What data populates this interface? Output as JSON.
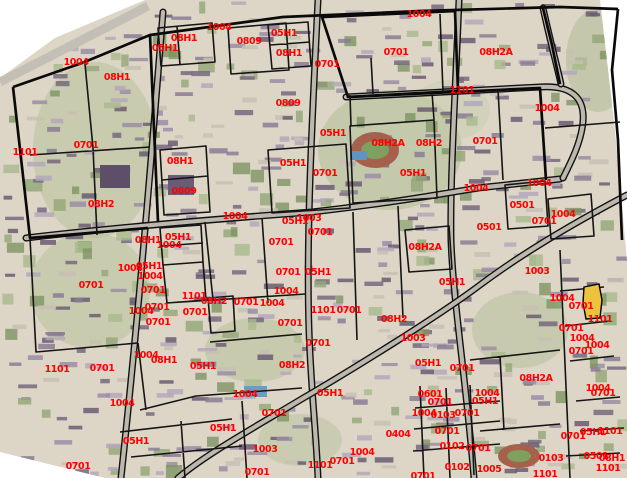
{
  "map": {
    "width": 627,
    "height": 478,
    "colors": {
      "label": "#ff0000",
      "boundary": "#000000",
      "road": "#bdb8ae",
      "ground": "#ddd5c6",
      "highlight": "#edc23f"
    },
    "highlight_parcel": {
      "label": "0701",
      "x": 591,
      "y": 302
    },
    "labels": [
      {
        "t": "1004",
        "x": 76,
        "y": 62
      },
      {
        "t": "08H1",
        "x": 117,
        "y": 77
      },
      {
        "t": "1101",
        "x": 25,
        "y": 152
      },
      {
        "t": "0701",
        "x": 86,
        "y": 145
      },
      {
        "t": "08H2",
        "x": 101,
        "y": 204
      },
      {
        "t": "05H1",
        "x": 165,
        "y": 48
      },
      {
        "t": "08H1",
        "x": 184,
        "y": 38
      },
      {
        "t": "1004",
        "x": 219,
        "y": 27
      },
      {
        "t": "0809",
        "x": 249,
        "y": 41
      },
      {
        "t": "05H1",
        "x": 284,
        "y": 33
      },
      {
        "t": "08H1",
        "x": 289,
        "y": 53
      },
      {
        "t": "0701",
        "x": 327,
        "y": 64
      },
      {
        "t": "1004",
        "x": 419,
        "y": 14
      },
      {
        "t": "0701",
        "x": 396,
        "y": 52
      },
      {
        "t": "08H2A",
        "x": 496,
        "y": 52
      },
      {
        "t": "1101",
        "x": 462,
        "y": 90
      },
      {
        "t": "1004",
        "x": 547,
        "y": 108
      },
      {
        "t": "0809",
        "x": 288,
        "y": 103
      },
      {
        "t": "08H1",
        "x": 180,
        "y": 161
      },
      {
        "t": "05H1",
        "x": 293,
        "y": 163
      },
      {
        "t": "0701",
        "x": 325,
        "y": 173
      },
      {
        "t": "0809",
        "x": 184,
        "y": 191
      },
      {
        "t": "05H1",
        "x": 333,
        "y": 133
      },
      {
        "t": "08H2A",
        "x": 388,
        "y": 143
      },
      {
        "t": "08H2",
        "x": 429,
        "y": 143
      },
      {
        "t": "0701",
        "x": 485,
        "y": 141
      },
      {
        "t": "05H1",
        "x": 413,
        "y": 173
      },
      {
        "t": "1004",
        "x": 235,
        "y": 216
      },
      {
        "t": "1004",
        "x": 476,
        "y": 188
      },
      {
        "t": "1004",
        "x": 539,
        "y": 183
      },
      {
        "t": "0501",
        "x": 522,
        "y": 205
      },
      {
        "t": "1004",
        "x": 563,
        "y": 214
      },
      {
        "t": "0701",
        "x": 544,
        "y": 221
      },
      {
        "t": "0501",
        "x": 489,
        "y": 227
      },
      {
        "t": "05H1",
        "x": 295,
        "y": 221
      },
      {
        "t": "1003",
        "x": 309,
        "y": 218
      },
      {
        "t": "0701",
        "x": 320,
        "y": 232
      },
      {
        "t": "08H1",
        "x": 148,
        "y": 240
      },
      {
        "t": "05H1",
        "x": 178,
        "y": 237
      },
      {
        "t": "1004",
        "x": 169,
        "y": 245
      },
      {
        "t": "0701",
        "x": 281,
        "y": 242
      },
      {
        "t": "08H2A",
        "x": 425,
        "y": 247
      },
      {
        "t": "1003",
        "x": 537,
        "y": 271
      },
      {
        "t": "05H1",
        "x": 452,
        "y": 282
      },
      {
        "t": "1004",
        "x": 130,
        "y": 268
      },
      {
        "t": "05H1",
        "x": 149,
        "y": 266
      },
      {
        "t": "1004",
        "x": 150,
        "y": 276
      },
      {
        "t": "0701",
        "x": 91,
        "y": 285
      },
      {
        "t": "0701",
        "x": 153,
        "y": 290
      },
      {
        "t": "1101",
        "x": 194,
        "y": 296
      },
      {
        "t": "0701",
        "x": 288,
        "y": 272
      },
      {
        "t": "05H1",
        "x": 318,
        "y": 272
      },
      {
        "t": "1004",
        "x": 286,
        "y": 291
      },
      {
        "t": "1004",
        "x": 141,
        "y": 311
      },
      {
        "t": "0701",
        "x": 157,
        "y": 307
      },
      {
        "t": "0701",
        "x": 158,
        "y": 322
      },
      {
        "t": "0701",
        "x": 195,
        "y": 312
      },
      {
        "t": "08H2",
        "x": 214,
        "y": 301
      },
      {
        "t": "0701",
        "x": 246,
        "y": 302
      },
      {
        "t": "1004",
        "x": 272,
        "y": 303
      },
      {
        "t": "1101",
        "x": 323,
        "y": 310
      },
      {
        "t": "0701",
        "x": 349,
        "y": 310
      },
      {
        "t": "08H2",
        "x": 394,
        "y": 319
      },
      {
        "t": "0701",
        "x": 290,
        "y": 323
      },
      {
        "t": "0701",
        "x": 318,
        "y": 343
      },
      {
        "t": "1004",
        "x": 146,
        "y": 355
      },
      {
        "t": "08H1",
        "x": 164,
        "y": 360
      },
      {
        "t": "1101",
        "x": 57,
        "y": 369
      },
      {
        "t": "0701",
        "x": 102,
        "y": 368
      },
      {
        "t": "05H1",
        "x": 203,
        "y": 366
      },
      {
        "t": "08H2",
        "x": 292,
        "y": 365
      },
      {
        "t": "1004",
        "x": 122,
        "y": 403
      },
      {
        "t": "1004",
        "x": 245,
        "y": 394
      },
      {
        "t": "05H1",
        "x": 330,
        "y": 393
      },
      {
        "t": "0701",
        "x": 274,
        "y": 413
      },
      {
        "t": "05H1",
        "x": 223,
        "y": 428
      },
      {
        "t": "05H1",
        "x": 136,
        "y": 441
      },
      {
        "t": "1003",
        "x": 265,
        "y": 449
      },
      {
        "t": "0701",
        "x": 78,
        "y": 466
      },
      {
        "t": "0701",
        "x": 257,
        "y": 472
      },
      {
        "t": "0404",
        "x": 398,
        "y": 434
      },
      {
        "t": "1004",
        "x": 362,
        "y": 452
      },
      {
        "t": "0701",
        "x": 342,
        "y": 461
      },
      {
        "t": "1101",
        "x": 320,
        "y": 465
      },
      {
        "t": "1003",
        "x": 413,
        "y": 338
      },
      {
        "t": "05H1",
        "x": 428,
        "y": 363
      },
      {
        "t": "0701",
        "x": 462,
        "y": 368
      },
      {
        "t": "08H2A",
        "x": 536,
        "y": 378
      },
      {
        "t": "0601",
        "x": 430,
        "y": 394
      },
      {
        "t": "0701",
        "x": 440,
        "y": 402
      },
      {
        "t": "1004",
        "x": 487,
        "y": 393
      },
      {
        "t": "05H1",
        "x": 485,
        "y": 401
      },
      {
        "t": "1004",
        "x": 424,
        "y": 413
      },
      {
        "t": "0103",
        "x": 443,
        "y": 415
      },
      {
        "t": "0701",
        "x": 467,
        "y": 413
      },
      {
        "t": "0701",
        "x": 447,
        "y": 431
      },
      {
        "t": "0102",
        "x": 452,
        "y": 446
      },
      {
        "t": "0701",
        "x": 478,
        "y": 448
      },
      {
        "t": "0102",
        "x": 457,
        "y": 467
      },
      {
        "t": "1005",
        "x": 489,
        "y": 469
      },
      {
        "t": "0103",
        "x": 551,
        "y": 458
      },
      {
        "t": "1101",
        "x": 545,
        "y": 474
      },
      {
        "t": "0701",
        "x": 423,
        "y": 476
      },
      {
        "t": "1004",
        "x": 562,
        "y": 298
      },
      {
        "t": "0701",
        "x": 581,
        "y": 306
      },
      {
        "t": "1101",
        "x": 600,
        "y": 319
      },
      {
        "t": "0701",
        "x": 571,
        "y": 328
      },
      {
        "t": "1004",
        "x": 582,
        "y": 338
      },
      {
        "t": "1004",
        "x": 597,
        "y": 345
      },
      {
        "t": "0701",
        "x": 581,
        "y": 351
      },
      {
        "t": "1004",
        "x": 598,
        "y": 388
      },
      {
        "t": "0701",
        "x": 603,
        "y": 393
      },
      {
        "t": "0701",
        "x": 573,
        "y": 436
      },
      {
        "t": "05H1",
        "x": 593,
        "y": 432
      },
      {
        "t": "1101",
        "x": 610,
        "y": 431
      },
      {
        "t": "0501",
        "x": 596,
        "y": 456
      },
      {
        "t": "08H1",
        "x": 612,
        "y": 458
      },
      {
        "t": "1101",
        "x": 608,
        "y": 468
      }
    ]
  }
}
